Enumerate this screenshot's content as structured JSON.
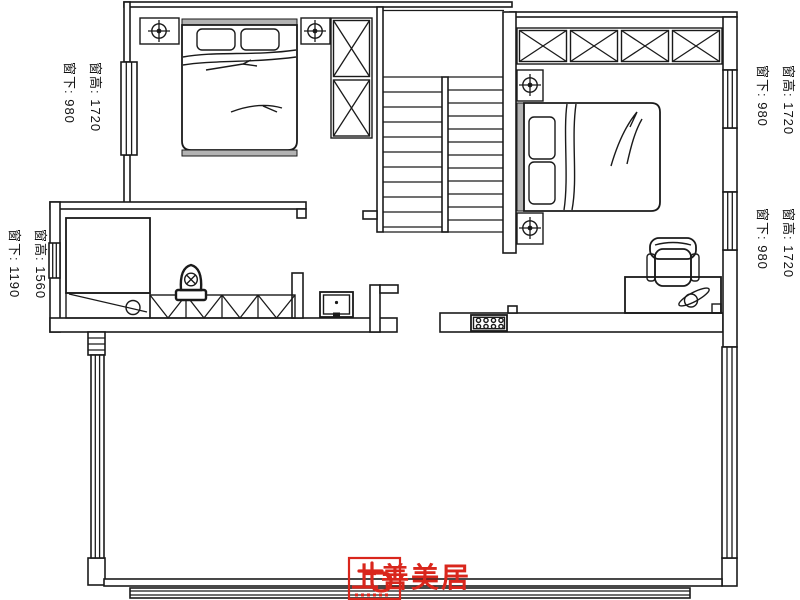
{
  "labels": {
    "left_top": {
      "line1": "窗高: 1720",
      "line2": "窗下: 980"
    },
    "left_middle": {
      "line1": "窗高: 1560",
      "line2": "窗下: 1190"
    },
    "right_top": {
      "line1": "窗高: 1720",
      "line2": "窗下: 980"
    },
    "right_middle": {
      "line1": "窗高: 1720",
      "line2": "窗下: 980"
    }
  },
  "logo": {
    "text": "上善美居",
    "color": "#d9261c"
  },
  "plan": {
    "background": "#ffffff",
    "line_color": "#1a1a1a",
    "furniture_gray": "#b3b3b3",
    "icons": {
      "ceiling-lamp": "circle-crosshair",
      "toilet-valve": "circle-x",
      "desk-lamp": "circle-leaf",
      "wardrobe-cell": "box-x",
      "outlet-panel": "box-8-circles"
    }
  }
}
